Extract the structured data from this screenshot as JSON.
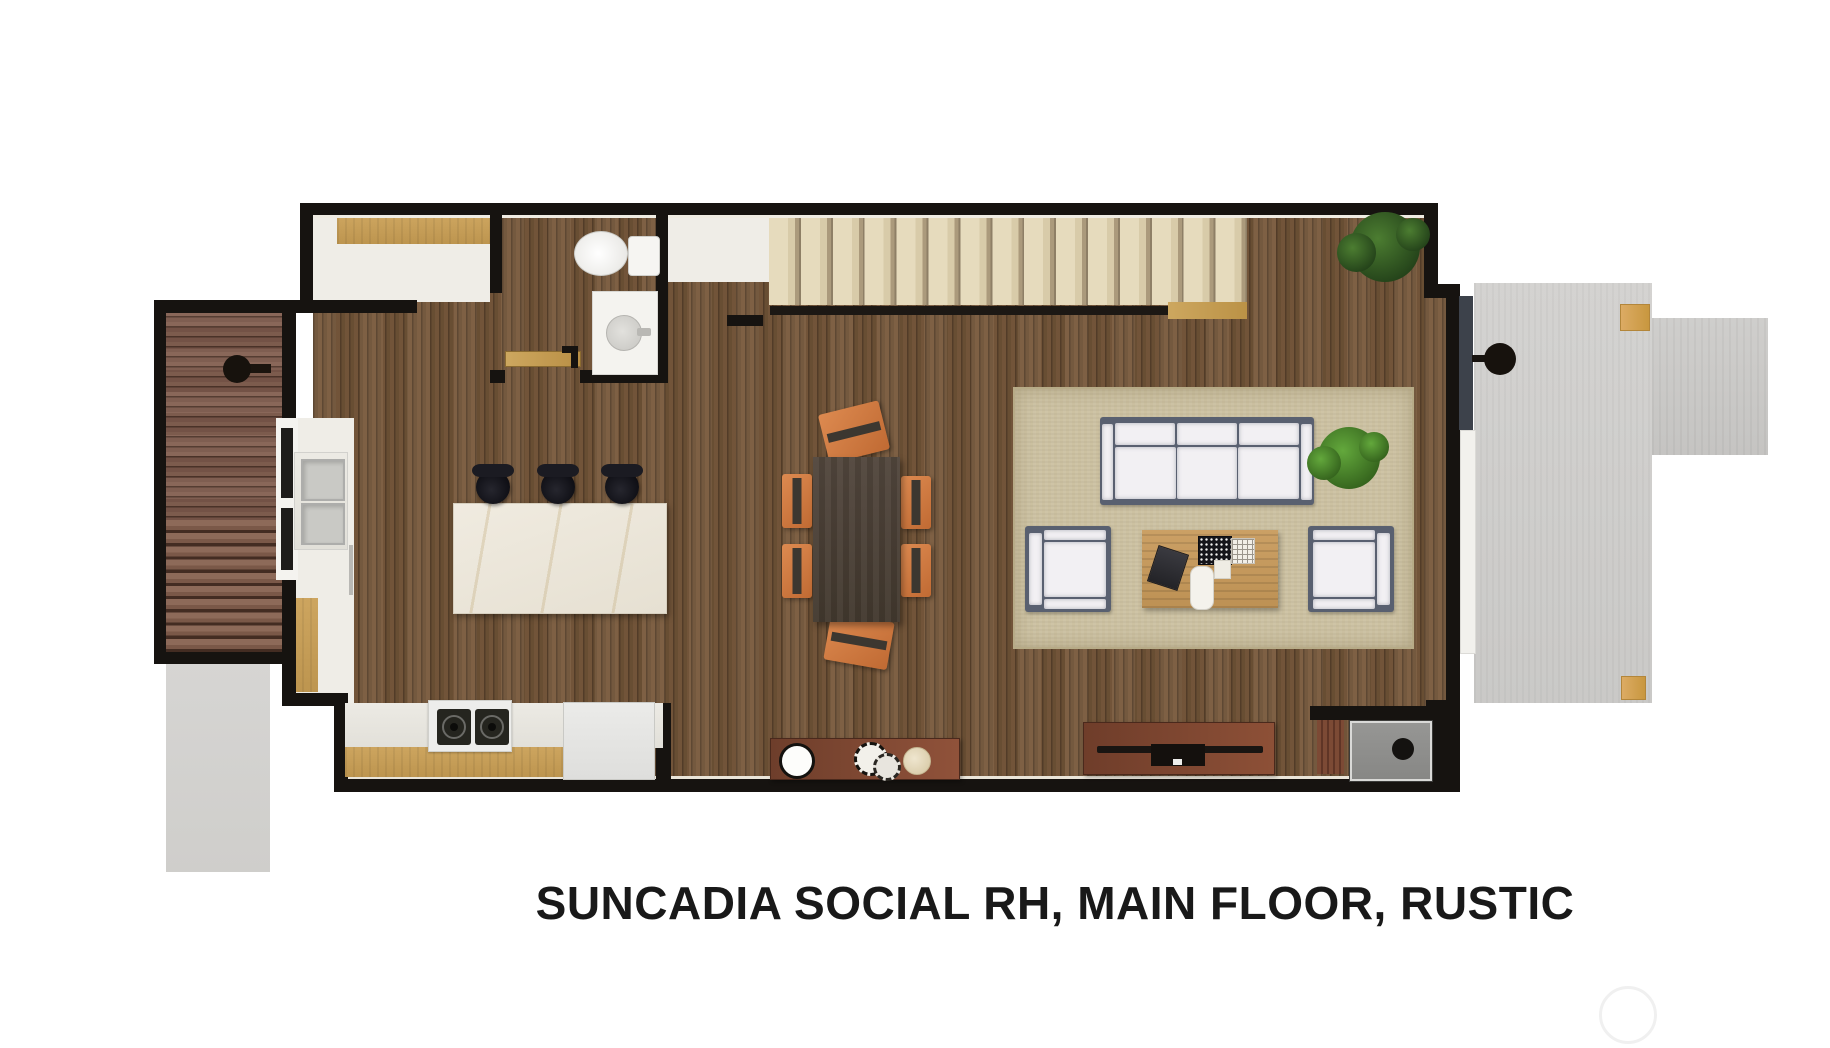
{
  "title": {
    "text": "SUNCADIA SOCIAL RH, MAIN FLOOR, RUSTIC"
  },
  "watermark": {
    "shape": "circle"
  },
  "palette": {
    "wall": "#161310",
    "title_color": "#191919",
    "floor_wood": "#6e5236",
    "deck_wood": "#7a574a",
    "stair_tread": "#d8cba9",
    "rug": "#ccc1a1",
    "patio_concrete": "#d1d0ce",
    "walkway_concrete": "#d4d3d1",
    "island_marble": "#ece7db",
    "counter_oak": "#c49c59",
    "dining_chair_orange": "#cf7742",
    "dining_table": "#4a4034",
    "sofa_frame": "#596070",
    "cushion_white": "#f2f0f3",
    "console_wood": "#8d5037",
    "plant_dark_green": "#2f5a20",
    "plant_light_green": "#63a83c",
    "tan_block": "#d8a760",
    "door_panel_gray": "#3d424b",
    "fireplace_gray": "#8e8e8c"
  }
}
